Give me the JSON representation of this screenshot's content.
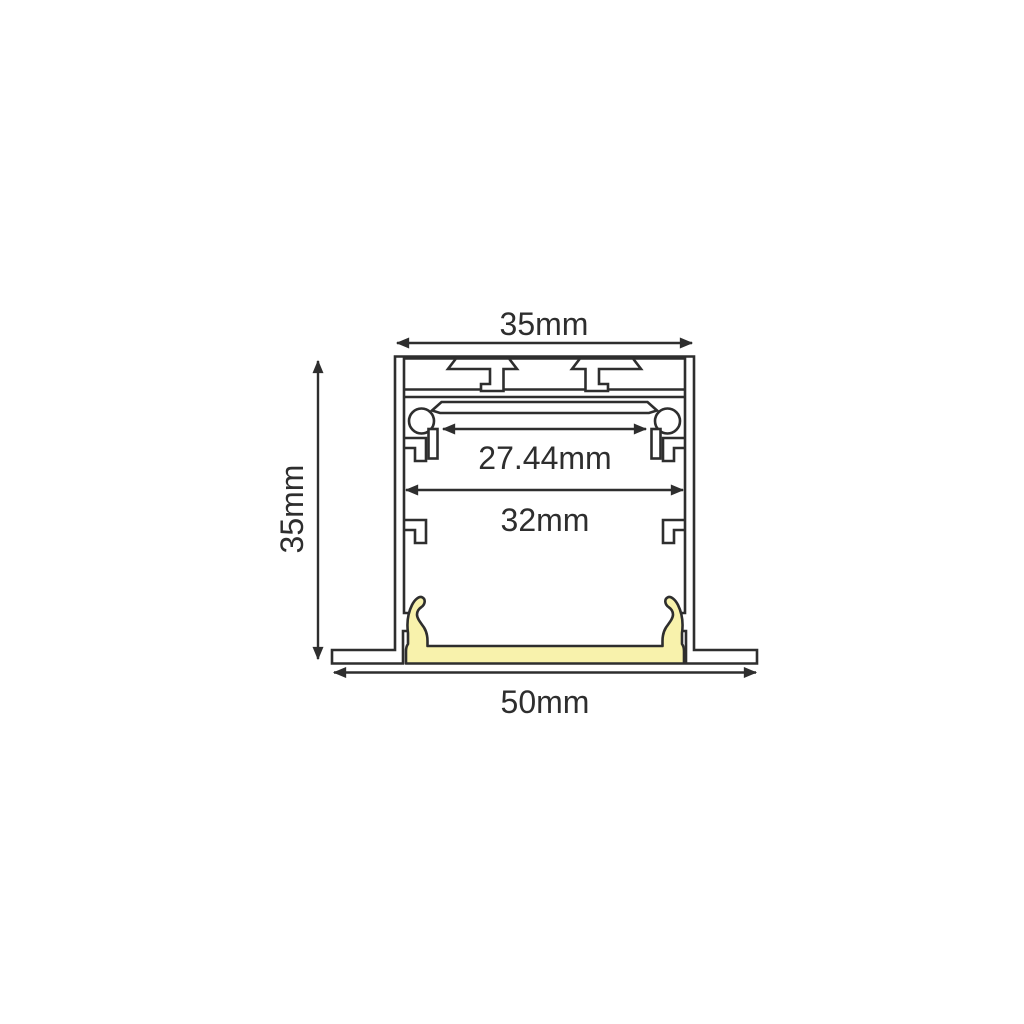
{
  "diagram": {
    "type": "technical cross-section drawing",
    "subject": "recessed LED aluminium profile with diffuser",
    "dimensions": {
      "top_width": "35mm",
      "height": "35mm",
      "clip_inner_width": "27.44mm",
      "inner_width": "32mm",
      "overall_width": "50mm"
    },
    "colors": {
      "outline": "#2e2e2e",
      "background": "#ffffff",
      "diffuser_fill": "#f8f2ac"
    }
  }
}
